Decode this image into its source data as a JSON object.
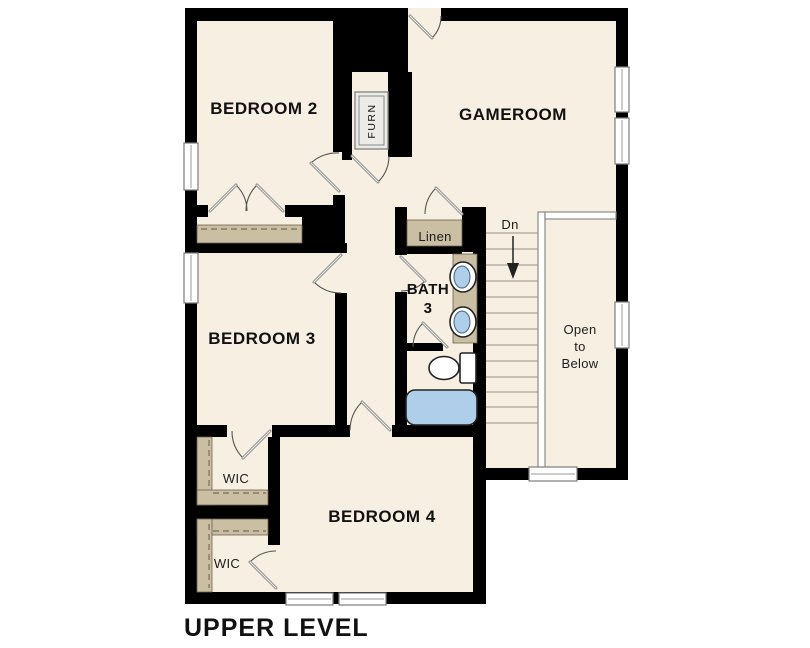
{
  "plan_title": "UPPER LEVEL",
  "colors": {
    "floor": "#f7efe2",
    "wall": "#000000",
    "tan": "#cbbfa3",
    "blue": "#aecee9",
    "tread": "#b9b1a1"
  },
  "rooms": {
    "bedroom2": "BEDROOM 2",
    "gameroom": "GAMEROOM",
    "bedroom3": "BEDROOM 3",
    "bedroom4": "BEDROOM 4",
    "bath": {
      "line1": "BATH",
      "line2": "3"
    },
    "wic_upper": "WIC",
    "wic_lower": "WIC",
    "linen": "Linen",
    "furnace": "FURN"
  },
  "stairs": {
    "label": "Dn"
  },
  "open_to_below": {
    "line1": "Open",
    "line2": "to",
    "line3": "Below"
  }
}
